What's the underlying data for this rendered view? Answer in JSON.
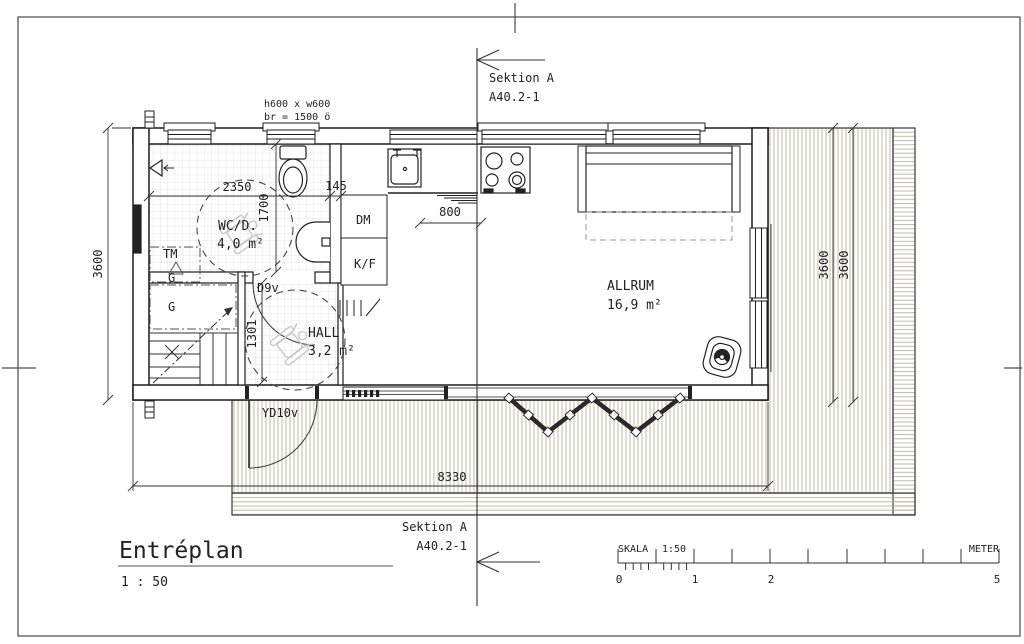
{
  "title": {
    "name": "Entréplan",
    "scale": "1 : 50"
  },
  "section_marker": {
    "label": "Sektion A",
    "ref": "A40.2-1"
  },
  "rooms": {
    "wc": {
      "name": "WC/D.",
      "area": "4,0 m²"
    },
    "hall": {
      "name": "HALL",
      "area": "3,2 m²"
    },
    "allrum": {
      "name": "ALLRUM",
      "area": "16,9 m²"
    }
  },
  "fixtures": {
    "dishwasher": "DM",
    "fridge_freezer": "K/F",
    "washing_machine": "TM",
    "wardrobe1": "G",
    "wardrobe2": "G"
  },
  "doors": {
    "inner_door": "D9v",
    "entry_door": "YD10v"
  },
  "window_note": {
    "line1": "h600 x w600",
    "line2": "br = 1500 ö"
  },
  "dimensions": {
    "wc_width": "2350",
    "wall_gap": "145",
    "wc_depth": "1700",
    "counter": "800",
    "left_height": "3600",
    "right_height_1": "3600",
    "right_height_2": "3600",
    "total_width": "8330",
    "hall_width": "1301"
  },
  "scale_bar": {
    "label": "SKALA",
    "ratio": "1:50",
    "unit": "METER",
    "ticks": {
      "t0": "0",
      "t1": "1",
      "t2": "2",
      "t5": "5"
    }
  },
  "colors": {
    "ink": "#222222",
    "deck_hatch": "#b8b49c",
    "tile": "#d8d8d8"
  }
}
